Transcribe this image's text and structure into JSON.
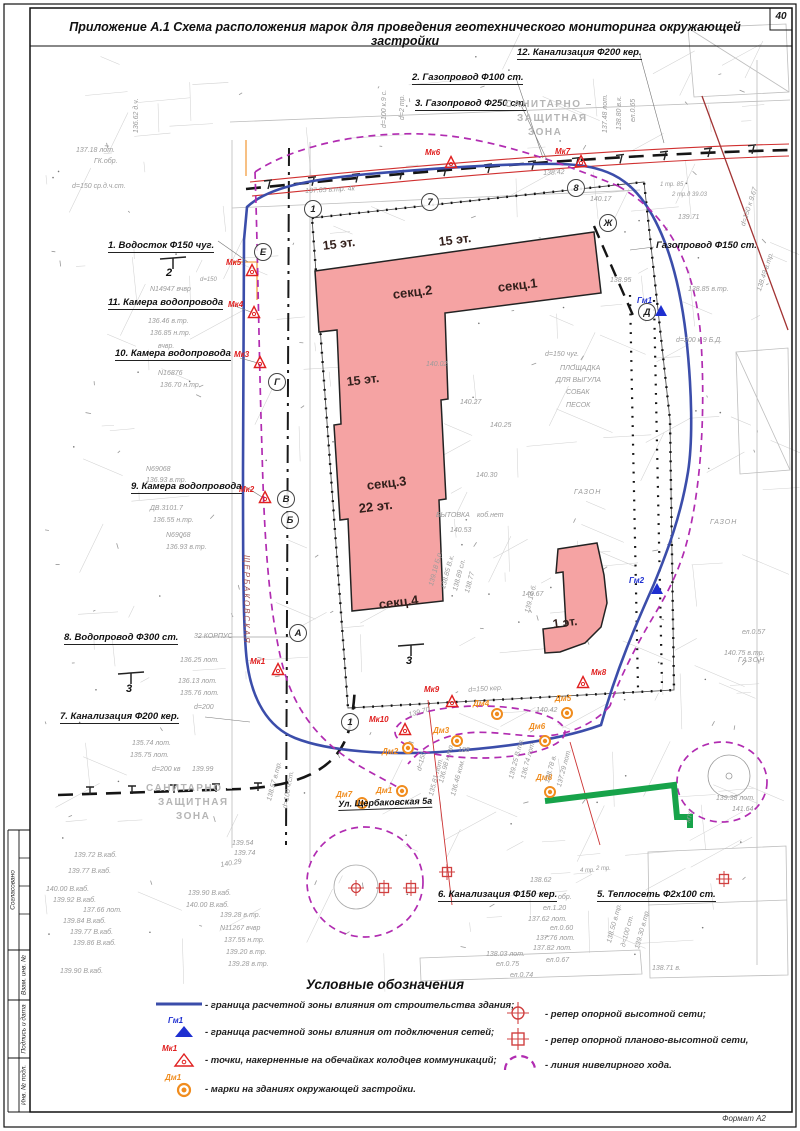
{
  "title": "Приложение А.1 Схема расположения марок для проведения геотехнического мониторинга окружающей застройки",
  "page": {
    "number": "40",
    "format_label": "Формат А2"
  },
  "stamp": {
    "items": [
      "Согласовано",
      "Взам. инв. №",
      "Подпись и дата",
      "Инв. № подл."
    ]
  },
  "colors": {
    "building_fill": "#f5a3a3",
    "influence_zone": "#3b4daa",
    "leveling_line": "#b12cb1",
    "utility_red": "#d03030",
    "heat_green": "#17a34a",
    "marker_orange": "#f08c1e",
    "marker_red": "#e02020",
    "marker_blue": "#1e2fd0"
  },
  "map": {
    "street_label": "Ул. Щербаковская 5а",
    "sz_top": [
      "САНИТАРНО –",
      "ЗАЩИТНАЯ",
      "ЗОНА"
    ],
    "sz_left": [
      "САНИТАРНО –",
      "ЗАЩИТНАЯ",
      "ЗОНА"
    ],
    "building": {
      "sec1": "секц.1",
      "sec2": "секц.2",
      "sec3": "секц.3",
      "sec4": "секц.4",
      "floors15": "15 эт.",
      "floors22": "22 эт.",
      "floors1": "1 эт."
    },
    "utilities": [
      {
        "label": "1. Водосток Ф150 чуг.",
        "x": 108,
        "y": 241
      },
      {
        "label": "11. Камера водопровода",
        "x": 108,
        "y": 298
      },
      {
        "label": "10. Камера водопровода",
        "x": 115,
        "y": 349
      },
      {
        "label": "9. Камера водопровода",
        "x": 131,
        "y": 482
      },
      {
        "label": "8. Водопровод Ф300 ст.",
        "x": 64,
        "y": 633
      },
      {
        "label": "7. Канализация Ф200 кер.",
        "x": 60,
        "y": 712
      },
      {
        "label": "2. Газопровод Ф100 ст.",
        "x": 412,
        "y": 73
      },
      {
        "label": "3. Газопровод Ф250 ст.",
        "x": 415,
        "y": 99
      },
      {
        "label": "12. Канализация Ф200 кер.",
        "x": 517,
        "y": 48
      },
      {
        "label": "Газопровод Ф150 ст.",
        "x": 656,
        "y": 241,
        "nound": true
      },
      {
        "label": "6. Канализация Ф150 кер.",
        "x": 438,
        "y": 890
      },
      {
        "label": "5. Теплосеть Ф2х100 ст.",
        "x": 597,
        "y": 890
      }
    ],
    "axis_bubbles": [
      {
        "label": "1",
        "x": 313,
        "y": 209
      },
      {
        "label": "7",
        "x": 430,
        "y": 202
      },
      {
        "label": "8",
        "x": 576,
        "y": 188
      },
      {
        "label": "Е",
        "x": 263,
        "y": 252
      },
      {
        "label": "Г",
        "x": 277,
        "y": 382
      },
      {
        "label": "В",
        "x": 286,
        "y": 499
      },
      {
        "label": "Б",
        "x": 290,
        "y": 520
      },
      {
        "label": "А",
        "x": 298,
        "y": 633
      },
      {
        "label": "Ж",
        "x": 608,
        "y": 223
      },
      {
        "label": "Д",
        "x": 647,
        "y": 312
      },
      {
        "label": "1",
        "x": 350,
        "y": 722
      }
    ],
    "mk_markers": [
      {
        "label": "Мк5",
        "x": 252,
        "y": 271,
        "lx": -26,
        "ly": -6
      },
      {
        "label": "Мк4",
        "x": 254,
        "y": 313,
        "lx": -26,
        "ly": -6
      },
      {
        "label": "Мк3",
        "x": 260,
        "y": 363,
        "lx": -26,
        "ly": -6
      },
      {
        "label": "Мк2",
        "x": 265,
        "y": 498,
        "lx": -26,
        "ly": -6
      },
      {
        "label": "Мк1",
        "x": 278,
        "y": 670,
        "lx": -28,
        "ly": -6
      },
      {
        "label": "Мк6",
        "x": 451,
        "y": 163,
        "lx": -26,
        "ly": -8
      },
      {
        "label": "Мк7",
        "x": 581,
        "y": 162,
        "lx": -26,
        "ly": -8
      },
      {
        "label": "Мк8",
        "x": 583,
        "y": 683,
        "lx": 8,
        "ly": -8
      },
      {
        "label": "Мк9",
        "x": 452,
        "y": 702,
        "lx": -28,
        "ly": -10
      },
      {
        "label": "Мк10",
        "x": 405,
        "y": 730,
        "lx": -36,
        "ly": -8
      }
    ],
    "dm_markers": [
      {
        "label": "Дм2",
        "x": 408,
        "y": 748,
        "lx": -26,
        "ly": 6
      },
      {
        "label": "Дм3",
        "x": 457,
        "y": 741,
        "lx": -24,
        "ly": -8
      },
      {
        "label": "Дм4",
        "x": 497,
        "y": 714,
        "lx": -24,
        "ly": -8
      },
      {
        "label": "Дм5",
        "x": 567,
        "y": 713,
        "lx": -12,
        "ly": -12
      },
      {
        "label": "Дм6",
        "x": 545,
        "y": 741,
        "lx": -16,
        "ly": -12
      },
      {
        "label": "Дм1",
        "x": 402,
        "y": 791,
        "lx": -26,
        "ly": 2
      },
      {
        "label": "Дм7",
        "x": 362,
        "y": 803,
        "lx": -26,
        "ly": -6
      },
      {
        "label": "Дм8",
        "x": 550,
        "y": 792,
        "lx": -14,
        "ly": -12
      }
    ],
    "gm_markers": [
      {
        "label": "Гм1",
        "x": 661,
        "y": 311,
        "lx": -24,
        "ly": -8
      },
      {
        "label": "Гм2",
        "x": 657,
        "y": 589,
        "lx": -28,
        "ly": -6
      }
    ],
    "repers": [
      {
        "type": "circle",
        "x": 356,
        "y": 888
      },
      {
        "type": "square",
        "x": 384,
        "y": 888
      },
      {
        "type": "square",
        "x": 411,
        "y": 888
      },
      {
        "type": "square",
        "x": 447,
        "y": 872
      },
      {
        "type": "square",
        "x": 724,
        "y": 879
      }
    ],
    "annotations": [
      {
        "t": "137.18 лот.",
        "x": 76,
        "y": 147
      },
      {
        "t": "ГК.обр.",
        "x": 94,
        "y": 158
      },
      {
        "t": "d=150 ср.д.ч.ст.",
        "x": 72,
        "y": 183
      },
      {
        "t": "136.62 д.ч.",
        "x": 133,
        "y": 133,
        "r": -90
      },
      {
        "t": "d=100 к.9 с.",
        "x": 381,
        "y": 128,
        "r": -90
      },
      {
        "t": "d=2 тр.",
        "x": 399,
        "y": 120,
        "r": -90
      },
      {
        "t": "137.48 лот.",
        "x": 602,
        "y": 133,
        "r": -90
      },
      {
        "t": "138.80 в.к.",
        "x": 616,
        "y": 130,
        "r": -90
      },
      {
        "t": "ел.0.65",
        "x": 630,
        "y": 122,
        "r": -90
      },
      {
        "t": "137.85 в.тр. 4к",
        "x": 305,
        "y": 188,
        "r": -3
      },
      {
        "t": "138.42",
        "x": 543,
        "y": 170,
        "r": -3
      },
      {
        "t": "1 тр. 85",
        "x": 660,
        "y": 182,
        "s": 6
      },
      {
        "t": "2 тр.д 39.03",
        "x": 672,
        "y": 192,
        "s": 6
      },
      {
        "t": "140.17",
        "x": 590,
        "y": 196
      },
      {
        "t": "139.71",
        "x": 678,
        "y": 214
      },
      {
        "t": "N14947 вчвр",
        "x": 150,
        "y": 286
      },
      {
        "t": "136.46 в.тр.",
        "x": 148,
        "y": 318
      },
      {
        "t": "136.85 н.тр.",
        "x": 150,
        "y": 330
      },
      {
        "t": "вчвр.",
        "x": 158,
        "y": 343
      },
      {
        "t": "N16876",
        "x": 158,
        "y": 370
      },
      {
        "t": "136.70 н.тр.",
        "x": 160,
        "y": 382
      },
      {
        "t": "d=150",
        "x": 200,
        "y": 277,
        "s": 6
      },
      {
        "t": "N69068",
        "x": 146,
        "y": 466
      },
      {
        "t": "136.93 в.тр.",
        "x": 146,
        "y": 477
      },
      {
        "t": "ДВ.3101.7",
        "x": 150,
        "y": 505
      },
      {
        "t": "136.55 н.тр.",
        "x": 153,
        "y": 517
      },
      {
        "t": "N69068",
        "x": 166,
        "y": 532
      },
      {
        "t": "136.93 в.тр.",
        "x": 166,
        "y": 544
      },
      {
        "t": "32 КОРПУС",
        "x": 194,
        "y": 633
      },
      {
        "t": "136.25 лот.",
        "x": 180,
        "y": 657
      },
      {
        "t": "136.13 лот.",
        "x": 178,
        "y": 678
      },
      {
        "t": "135.76 лот.",
        "x": 180,
        "y": 690
      },
      {
        "t": "d=200",
        "x": 194,
        "y": 704
      },
      {
        "t": "135.75 лот.",
        "x": 130,
        "y": 752
      },
      {
        "t": "135.74 лот.",
        "x": 132,
        "y": 740
      },
      {
        "t": "d=200 кв",
        "x": 152,
        "y": 766
      },
      {
        "t": "139.99",
        "x": 192,
        "y": 766
      },
      {
        "t": "ЩЕРБАКОВСКАЯ",
        "x": 250,
        "y": 555,
        "r": 90,
        "c": "#a05050",
        "s": 8,
        "sp": 2
      },
      {
        "t": "2",
        "x": 166,
        "y": 268,
        "c": "#111",
        "s": 11,
        "b": true
      },
      {
        "t": "3",
        "x": 126,
        "y": 684,
        "c": "#111",
        "s": 11,
        "b": true
      },
      {
        "t": "3",
        "x": 406,
        "y": 656,
        "c": "#111",
        "s": 11,
        "b": true
      },
      {
        "t": "d=150 чуг.",
        "x": 545,
        "y": 351
      },
      {
        "t": "ПЛОЩАДКА",
        "x": 560,
        "y": 365
      },
      {
        "t": "ДЛЯ ВЫГУЛА",
        "x": 556,
        "y": 377
      },
      {
        "t": "СОБАК",
        "x": 566,
        "y": 389
      },
      {
        "t": "ПЕСОК",
        "x": 566,
        "y": 402
      },
      {
        "t": "140.02",
        "x": 426,
        "y": 361
      },
      {
        "t": "140.27",
        "x": 460,
        "y": 399
      },
      {
        "t": "140.25",
        "x": 490,
        "y": 422
      },
      {
        "t": "140.30",
        "x": 476,
        "y": 472
      },
      {
        "t": "БЫТОВКА",
        "x": 436,
        "y": 512
      },
      {
        "t": "коб.нет",
        "x": 477,
        "y": 512
      },
      {
        "t": "140.53",
        "x": 450,
        "y": 527
      },
      {
        "t": "140.67",
        "x": 522,
        "y": 591
      },
      {
        "t": "ГАЗОН",
        "x": 574,
        "y": 489,
        "sp": 1
      },
      {
        "t": "ГАЗОН",
        "x": 710,
        "y": 519,
        "sp": 1
      },
      {
        "t": "ГАЗОН",
        "x": 738,
        "y": 657,
        "sp": 1
      },
      {
        "t": "140.75 в.тр.",
        "x": 724,
        "y": 650
      },
      {
        "t": "ел.0.57",
        "x": 742,
        "y": 629
      },
      {
        "t": "138.95",
        "x": 610,
        "y": 277
      },
      {
        "t": "138.85 в.тр.",
        "x": 688,
        "y": 286
      },
      {
        "t": "d=200 к 9 Б.Д.",
        "x": 676,
        "y": 337
      },
      {
        "t": "138.49 в.тр.",
        "x": 756,
        "y": 290,
        "r": -72
      },
      {
        "t": "d=150 к 9.67",
        "x": 740,
        "y": 225,
        "r": -72
      },
      {
        "t": "139.18 Б.р.",
        "x": 428,
        "y": 585,
        "r": -75
      },
      {
        "t": "138.85 В.к.",
        "x": 440,
        "y": 588,
        "r": -75
      },
      {
        "t": "138.89 сл.",
        "x": 452,
        "y": 590,
        "r": -75
      },
      {
        "t": "138.77",
        "x": 464,
        "y": 592,
        "r": -75
      },
      {
        "t": "139.14 б.",
        "x": 524,
        "y": 612,
        "r": -75
      },
      {
        "t": "139.70",
        "x": 408,
        "y": 712,
        "r": -15
      },
      {
        "t": "d=150 кер.",
        "x": 468,
        "y": 687,
        "r": -4
      },
      {
        "t": "140.42",
        "x": 536,
        "y": 707
      },
      {
        "t": "188",
        "x": 458,
        "y": 747
      },
      {
        "t": "d=150",
        "x": 416,
        "y": 770,
        "r": -75
      },
      {
        "t": "136.98 н.тр.",
        "x": 438,
        "y": 782,
        "r": -75
      },
      {
        "t": "135.81 лот.",
        "x": 428,
        "y": 795,
        "r": -75
      },
      {
        "t": "136.46 ком.",
        "x": 450,
        "y": 795,
        "r": -75
      },
      {
        "t": "139.25 В.тр.",
        "x": 508,
        "y": 778,
        "r": -75
      },
      {
        "t": "136.74 лот.",
        "x": 520,
        "y": 778,
        "r": -75
      },
      {
        "t": "138.78 в.",
        "x": 544,
        "y": 782,
        "r": -75
      },
      {
        "t": "137.29 лот.",
        "x": 556,
        "y": 786,
        "r": -75
      },
      {
        "t": "139.38 лот.",
        "x": 716,
        "y": 795
      },
      {
        "t": "141.64",
        "x": 732,
        "y": 806
      },
      {
        "t": "МТС",
        "x": 686,
        "y": 822,
        "r": -75,
        "s": 6
      },
      {
        "t": "139.54",
        "x": 232,
        "y": 840
      },
      {
        "t": "139.74",
        "x": 234,
        "y": 850
      },
      {
        "t": "140.29",
        "x": 220,
        "y": 862,
        "r": -10
      },
      {
        "t": "138.57 в.тр.",
        "x": 266,
        "y": 800,
        "r": -75
      },
      {
        "t": "d=100 ч.ст.",
        "x": 282,
        "y": 808,
        "r": -80
      },
      {
        "t": "139.72 В.каб.",
        "x": 74,
        "y": 852
      },
      {
        "t": "139.77 В.каб.",
        "x": 68,
        "y": 868
      },
      {
        "t": "140.00 В.каб.",
        "x": 46,
        "y": 886
      },
      {
        "t": "139.92 В.каб.",
        "x": 53,
        "y": 897
      },
      {
        "t": "137.66 лот.",
        "x": 83,
        "y": 907
      },
      {
        "t": "139.84 В.каб.",
        "x": 63,
        "y": 918
      },
      {
        "t": "139.77 В.каб.",
        "x": 70,
        "y": 929
      },
      {
        "t": "139.86 В.каб.",
        "x": 73,
        "y": 940
      },
      {
        "t": "139.90 В.каб.",
        "x": 60,
        "y": 968
      },
      {
        "t": "139.90 В.каб.",
        "x": 188,
        "y": 890
      },
      {
        "t": "140.00 В.каб.",
        "x": 186,
        "y": 902
      },
      {
        "t": "139.28 в.тр.",
        "x": 220,
        "y": 912
      },
      {
        "t": "N11267 вчвр",
        "x": 220,
        "y": 925
      },
      {
        "t": "137.55 н.тр.",
        "x": 224,
        "y": 937
      },
      {
        "t": "139.20 в.тр.",
        "x": 226,
        "y": 949
      },
      {
        "t": "139.28 в.тр.",
        "x": 228,
        "y": 961
      },
      {
        "t": "138.62",
        "x": 530,
        "y": 877
      },
      {
        "t": "обр.",
        "x": 558,
        "y": 894
      },
      {
        "t": "ел.1.20",
        "x": 543,
        "y": 905
      },
      {
        "t": "137.62 лот.",
        "x": 528,
        "y": 916
      },
      {
        "t": "ел.0.60",
        "x": 550,
        "y": 925
      },
      {
        "t": "137.76 лот.",
        "x": 536,
        "y": 935
      },
      {
        "t": "137.82 лот.",
        "x": 533,
        "y": 945
      },
      {
        "t": "138.03 лот.",
        "x": 486,
        "y": 951
      },
      {
        "t": "ел.0.75",
        "x": 496,
        "y": 961
      },
      {
        "t": "ел.0.67",
        "x": 546,
        "y": 957
      },
      {
        "t": "ел.0.74",
        "x": 510,
        "y": 972
      },
      {
        "t": "138.71 в.",
        "x": 652,
        "y": 965
      },
      {
        "t": "138.50 в.тр.",
        "x": 606,
        "y": 942,
        "r": -75
      },
      {
        "t": "д=100 ст.",
        "x": 620,
        "y": 946,
        "r": -75
      },
      {
        "t": "139.30 в.тр.",
        "x": 634,
        "y": 948,
        "r": -75
      },
      {
        "t": "4 тр.",
        "x": 580,
        "y": 868,
        "s": 6
      },
      {
        "t": "2 тр.",
        "x": 596,
        "y": 866,
        "s": 6
      }
    ]
  },
  "legend": {
    "title": "Условные обозначения",
    "left": [
      {
        "symbol": "blue-line",
        "label": "- граница расчетной зоны влияния от строительства здания;"
      },
      {
        "symbol": "blue-triangle",
        "symbol_label": "Гм1",
        "label": "- граница расчетной зоны влияния от подключения сетей;"
      },
      {
        "symbol": "red-triangle",
        "symbol_label": "Мк1",
        "label": "- точки, накерненные на обечайках колодцев коммуникаций;"
      },
      {
        "symbol": "orange-circle",
        "symbol_label": "Дм1",
        "label": "- марки на зданиях окружающей застройки."
      }
    ],
    "right": [
      {
        "symbol": "reper-circle",
        "label": "- репер опорной высотной сети;"
      },
      {
        "symbol": "reper-square",
        "label": "- репер опорной планово-высотной сети,"
      },
      {
        "symbol": "level-line",
        "label": "- линия нивелирного хода."
      }
    ]
  }
}
